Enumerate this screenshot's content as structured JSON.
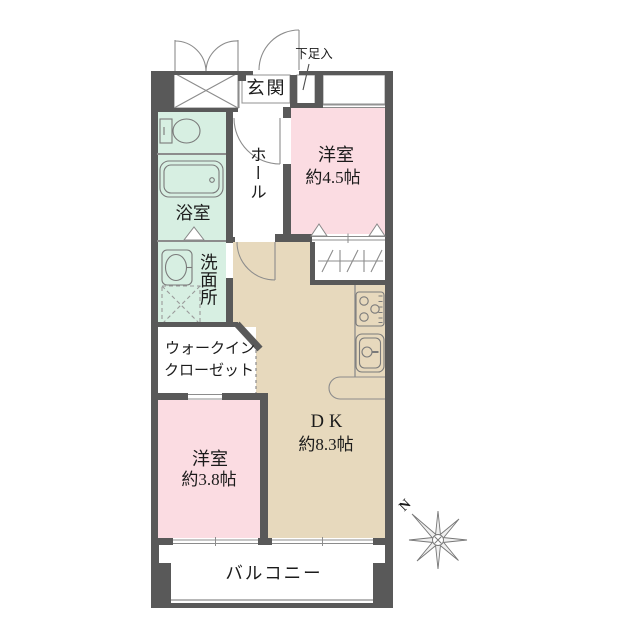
{
  "labels": {
    "genkan": "玄関",
    "shoe_storage": "下足入",
    "hall": "ホール",
    "western_room_1": {
      "name": "洋室",
      "size": "約4.5帖"
    },
    "bath": "浴室",
    "washroom": "洗面所",
    "walk_in_closet": {
      "line1": "ウォークイン",
      "line2": "クローゼット"
    },
    "western_room_2": {
      "name": "洋室",
      "size": "約3.8帖"
    },
    "dining_kitchen": {
      "name": "DK",
      "size": "約8.3帖"
    },
    "balcony": "バルコニー",
    "compass_north": "N"
  },
  "colors": {
    "wall": "#595959",
    "western_room": "#fbdce2",
    "wet_area": "#d7efe2",
    "dining_kitchen": "#e7d9bd",
    "line": "#8c8c8c"
  }
}
